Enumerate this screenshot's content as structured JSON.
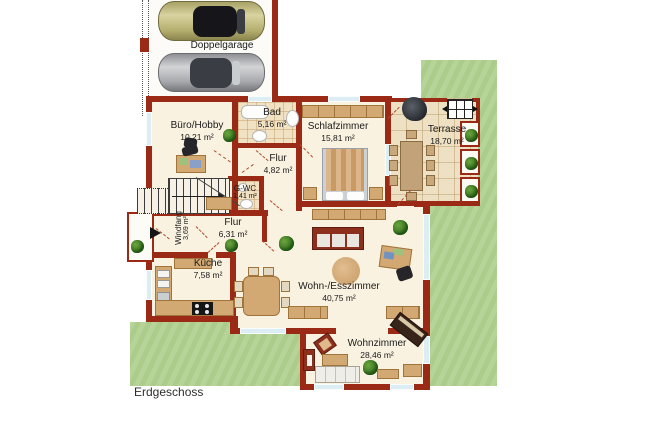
{
  "floor": {
    "label": "Erdgeschoss"
  },
  "garage": {
    "label": "Doppelgarage"
  },
  "rooms": {
    "buero": {
      "name": "Büro/Hobby",
      "area": "10,21 m²"
    },
    "bad": {
      "name": "Bad",
      "area": "5,16 m²"
    },
    "schlafzimmer": {
      "name": "Schlafzimmer",
      "area": "15,81 m²"
    },
    "terrasse": {
      "name": "Terrasse",
      "area": "18,70 m²"
    },
    "flur_klein": {
      "name": "Flur",
      "area": "4,82 m²"
    },
    "gwc": {
      "name": "G-WC",
      "area": "1,41 m²"
    },
    "windfang": {
      "name": "Windfang",
      "area": "3,69 m²"
    },
    "flur_gross": {
      "name": "Flur",
      "area": "6,31 m²"
    },
    "kueche": {
      "name": "Küche",
      "area": "7,58 m²"
    },
    "wohn_esszimmer": {
      "name": "Wohn-/Esszimmer",
      "area": "40,75 m²"
    },
    "wohnzimmer": {
      "name": "Wohnzimmer",
      "area": "28,46 m²"
    }
  },
  "colors": {
    "wall": "#9a2a15",
    "floor": "#f9f2e0",
    "lawn": "#b0d190",
    "tile": "#f0e2c2",
    "furniture": "#d2a873",
    "window": "#dceef4",
    "sofa_red": "#8c2f1d"
  }
}
